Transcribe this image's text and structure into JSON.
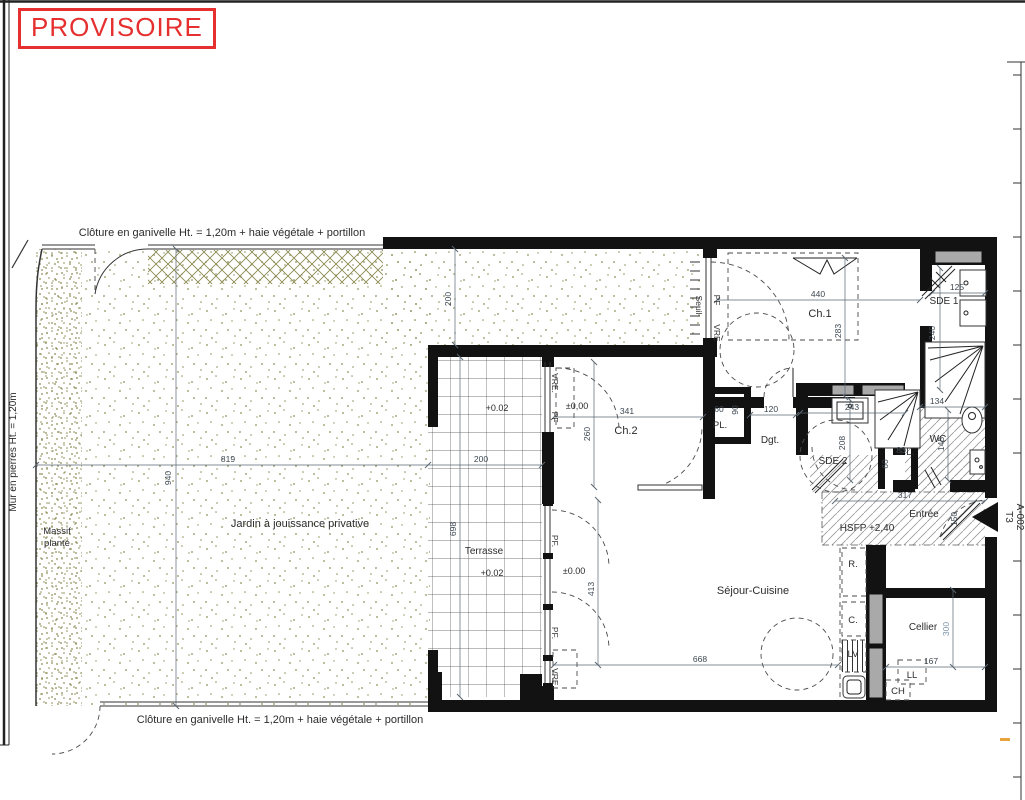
{
  "stamp": {
    "text": "PROVISOIRE"
  },
  "site": {
    "fence_label": "Clôture en ganivelle Ht. = 1,20m + haie végétale + portillon",
    "wall_label": "Mur en pierres Ht. = 1,20m",
    "massif_line1": "Massif",
    "massif_line2": "planté",
    "garden_label": "Jardin à jouissance privative"
  },
  "rooms": {
    "terrasse": "Terrasse",
    "ch1": "Ch.1",
    "sde1": "SDE 1",
    "ch2": "Ch.2",
    "pl": "PL.",
    "dgt": "Dgt.",
    "sde2": "SDE 2",
    "wc": "WC",
    "entree": "Entrée",
    "sejour": "Séjour-Cuisine",
    "cellier": "Cellier"
  },
  "levels": {
    "terrace": "+0.02",
    "ch2": "±0,00",
    "sejour": "±0.00",
    "hsfp": "HSFP +2,40"
  },
  "openings": {
    "seuil": "Seuil",
    "pf": "PF",
    "pf_dot": "PF.",
    "vre": "VRE",
    "vre_dot": "VRE."
  },
  "appliances": {
    "r": "R.",
    "c": "C.",
    "lv": "LV",
    "ll": "LL",
    "ch": "CH"
  },
  "dims": {
    "d819": "819",
    "d940": "940",
    "d200": "200",
    "d698": "698",
    "d440": "440",
    "d283": "283",
    "d125": "125",
    "d240": "240",
    "d341": "341",
    "d260": "260",
    "d60": "60",
    "d90": "90",
    "d120": "120",
    "d243": "243",
    "d208": "208",
    "d134": "134",
    "d145": "145",
    "d83": "83",
    "d317": "317",
    "d150": "150",
    "d668": "668",
    "d413": "413",
    "d300": "300",
    "d167": "167"
  },
  "titleblock": {
    "lot": "T3",
    "ref": "A-002"
  },
  "colors": {
    "stamp_red": "#e63030",
    "wall_black": "#121212",
    "stipple_olive": "#8f8f5a",
    "duct_gray": "#a9a9a9",
    "dim_blue": "#7b93aa",
    "corner_orange": "#e8a33d"
  }
}
